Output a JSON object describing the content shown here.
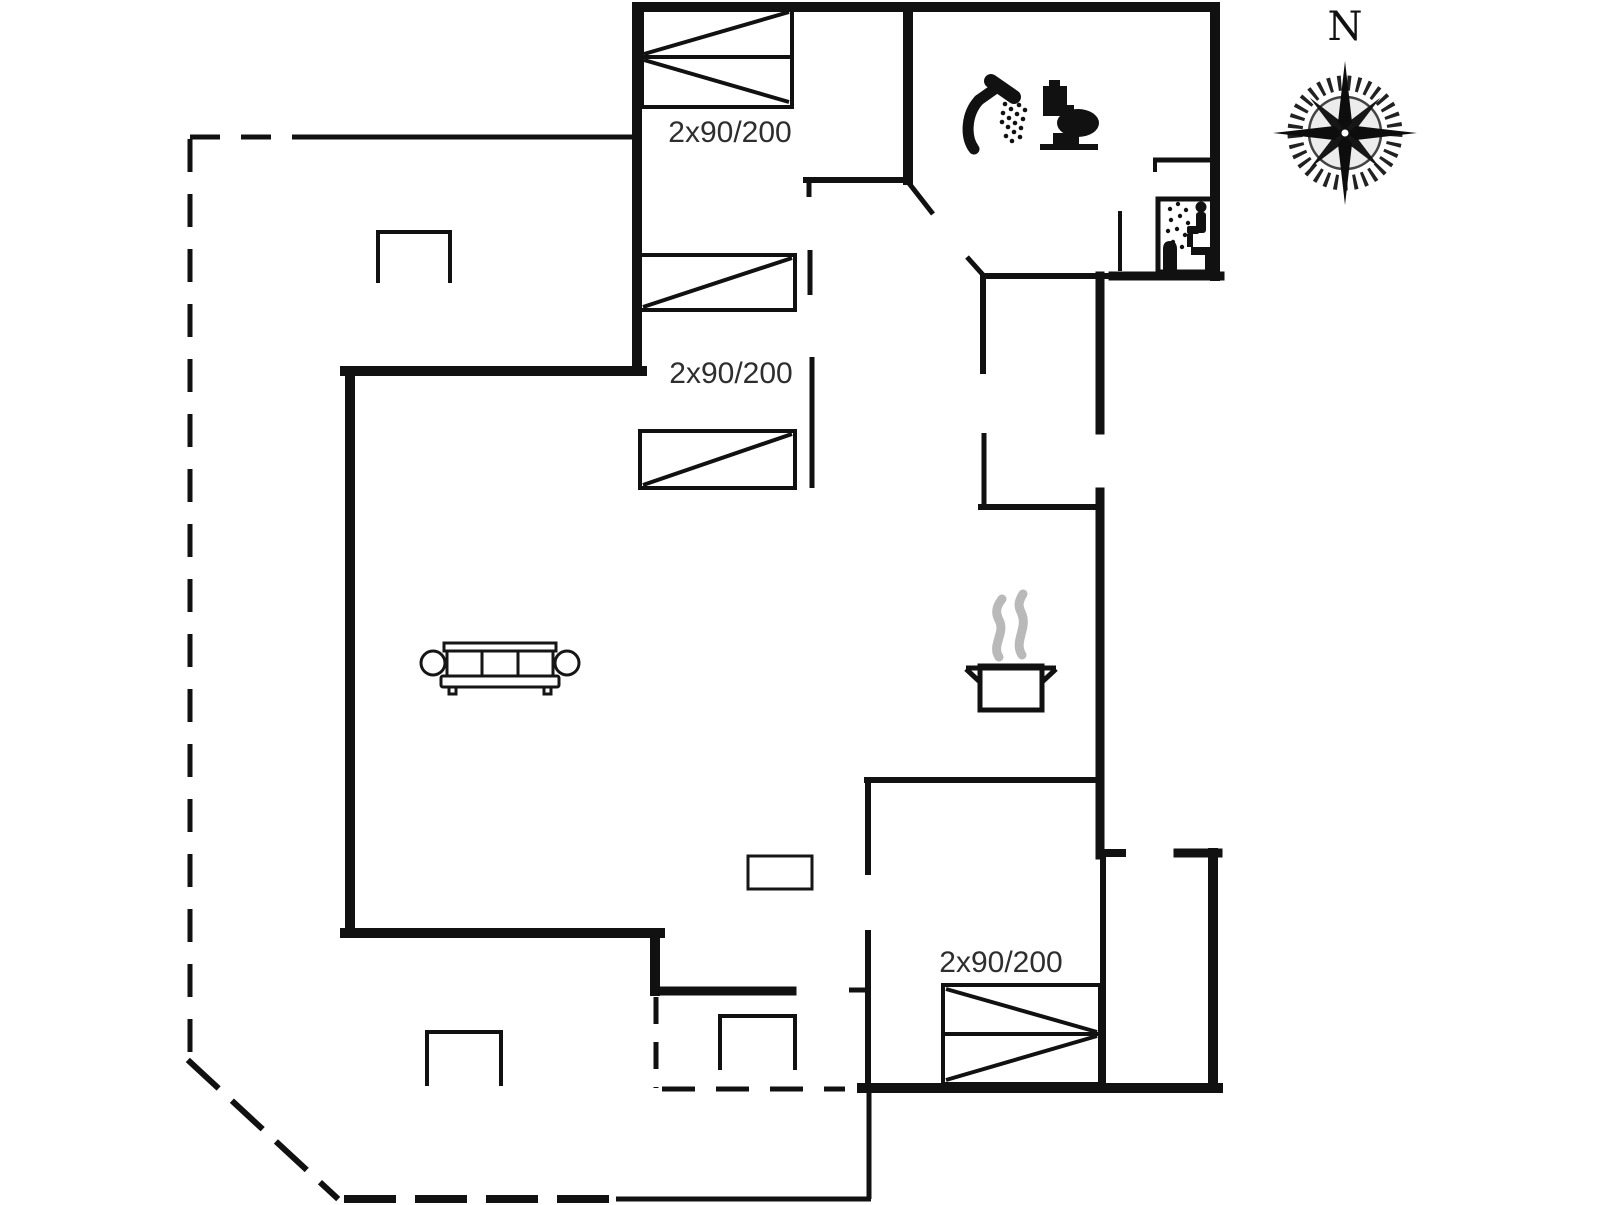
{
  "colors": {
    "ink": "#111111",
    "steam": "#b9b9b9",
    "label_text": "#2e2e2e"
  },
  "compass": {
    "north_label": "N"
  },
  "bed_labels": [
    {
      "text": "2x90/200"
    },
    {
      "text": "2x90/200"
    },
    {
      "text": "2x90/200"
    }
  ],
  "icons": [
    "double-bed-icon-top",
    "single-bed-icon-upper",
    "single-bed-icon-lower",
    "double-bed-icon-bottom",
    "sofa-icon",
    "cooking-pot-icon",
    "steam-icon",
    "shower-icon",
    "toilet-icon",
    "sauna-icon",
    "wood-stove-icon",
    "terrace-furniture-icon",
    "compass-rose-icon"
  ]
}
